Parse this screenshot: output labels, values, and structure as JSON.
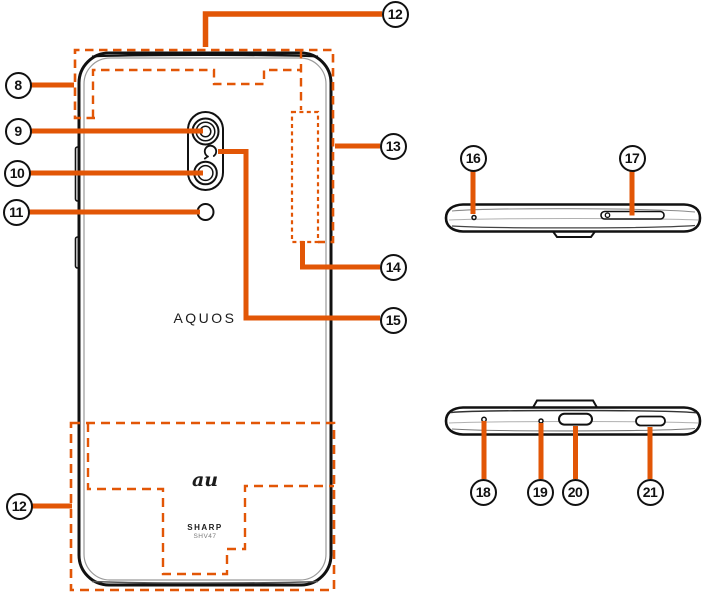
{
  "diagram": {
    "type": "device-parts-diagram",
    "views": [
      "back-view",
      "top-edge-view",
      "bottom-edge-view"
    ]
  },
  "colors": {
    "accent_orange": "#E25606",
    "outline_black": "#111111",
    "background": "#ffffff"
  },
  "phone_back": {
    "brand": "AQUOS",
    "carrier": "au",
    "manufacturer": "SHARP",
    "model": "SHV47"
  },
  "callouts": [
    {
      "label": "8"
    },
    {
      "label": "9"
    },
    {
      "label": "10"
    },
    {
      "label": "11"
    },
    {
      "label": "12"
    },
    {
      "label": "13"
    },
    {
      "label": "14"
    },
    {
      "label": "15"
    },
    {
      "label": "12"
    },
    {
      "label": "16"
    },
    {
      "label": "17"
    },
    {
      "label": "18"
    },
    {
      "label": "19"
    },
    {
      "label": "20"
    },
    {
      "label": "21"
    }
  ]
}
